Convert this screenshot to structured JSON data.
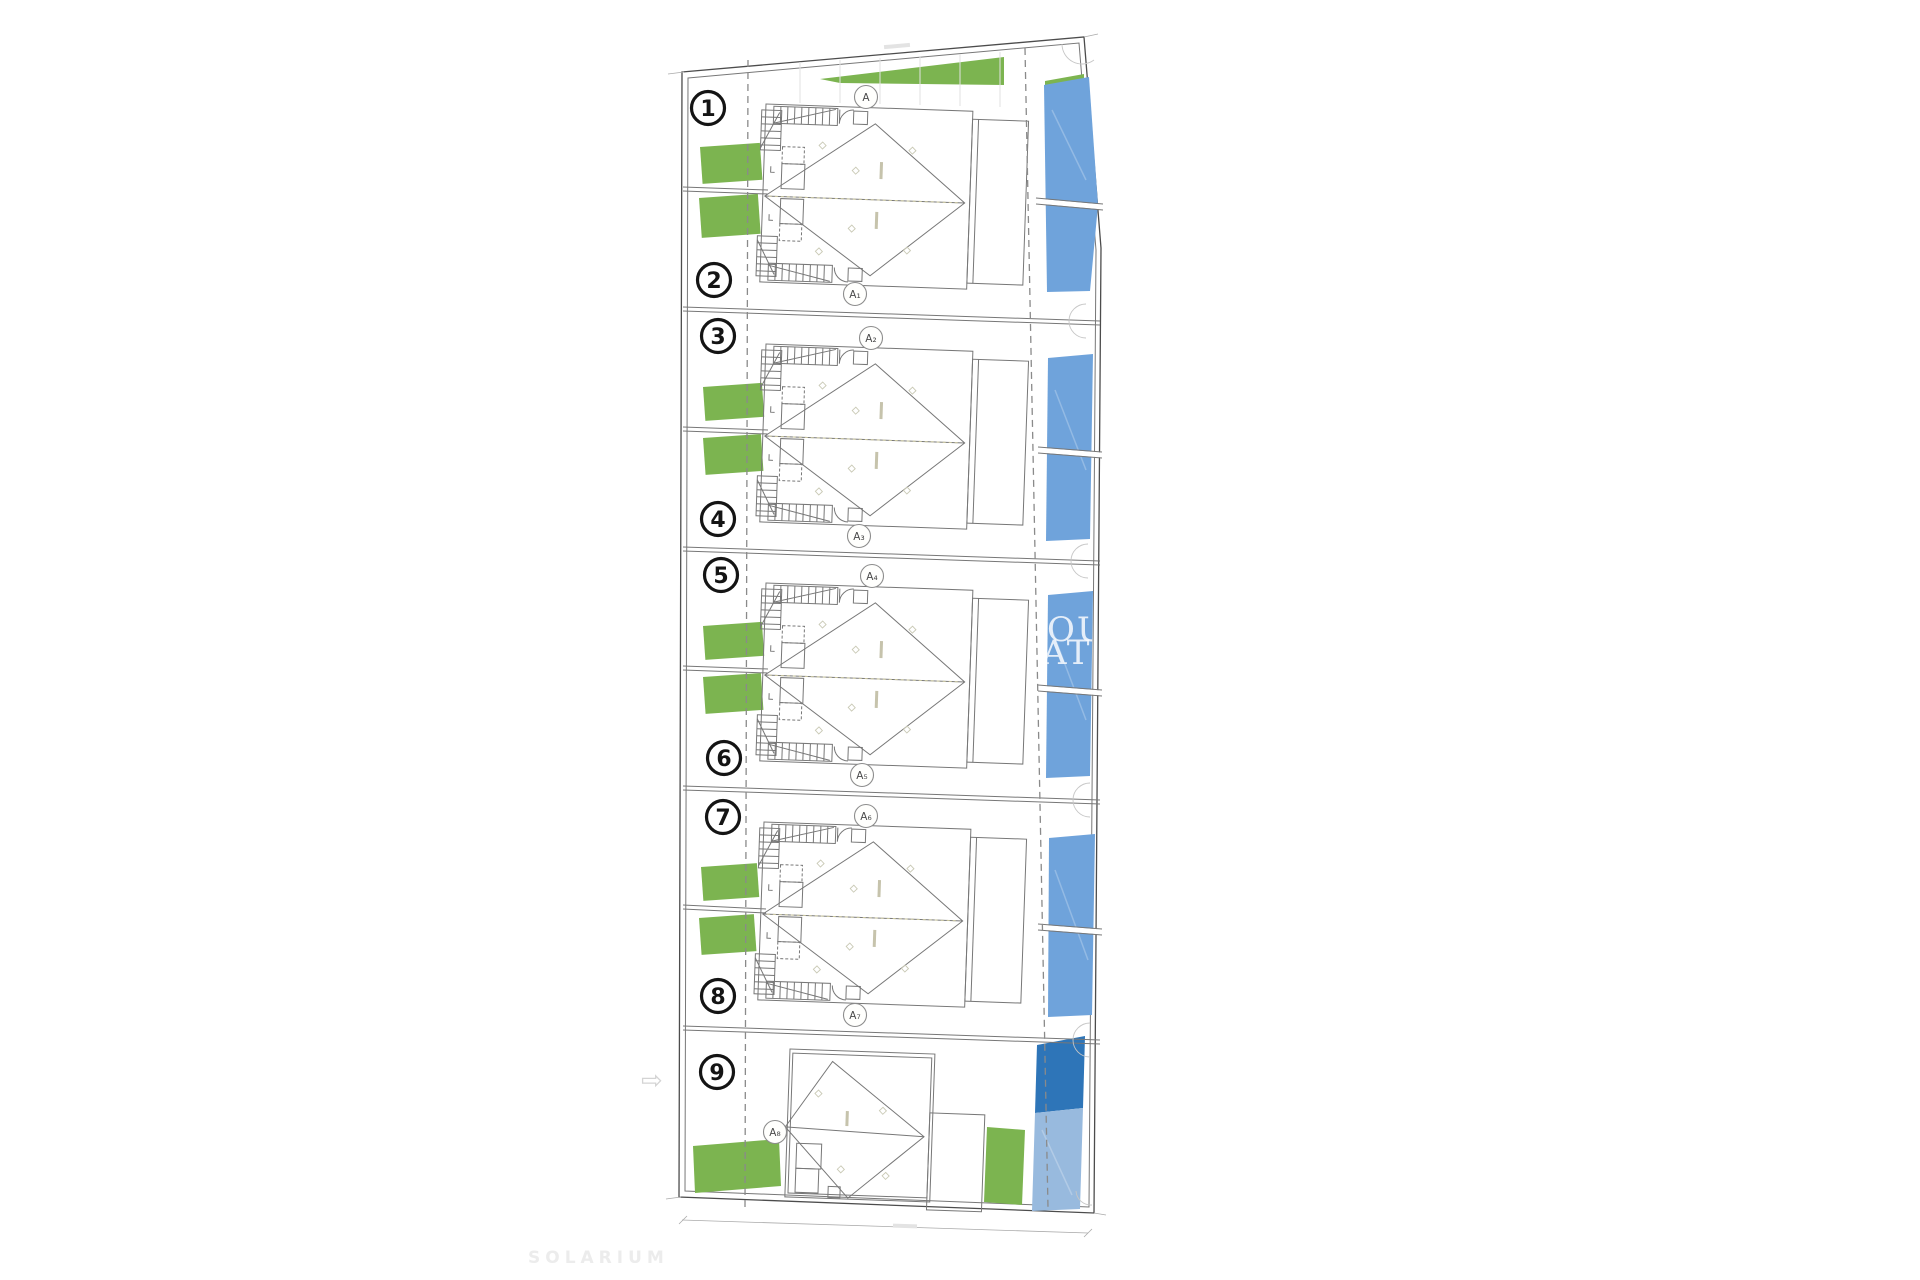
{
  "colors": {
    "garden": "#7cb450",
    "pool": "#6fa3db",
    "pool_dark": "#2e75b8",
    "pool_light": "#98bade",
    "shaft_green": "#dfe9d2"
  },
  "plan": {
    "unit_numbers": [
      "1",
      "2",
      "3",
      "4",
      "5",
      "6",
      "7",
      "8",
      "9"
    ],
    "circle_markers": [
      "A",
      "A₁",
      "A₂",
      "A₃",
      "A₄",
      "A₅",
      "A₆",
      "A₇",
      "A₈"
    ],
    "watermark": {
      "line1": "OUI",
      "line2": "ATE"
    },
    "footer_label": "SOLARIUM",
    "nav_arrow_icon": "⇨"
  }
}
